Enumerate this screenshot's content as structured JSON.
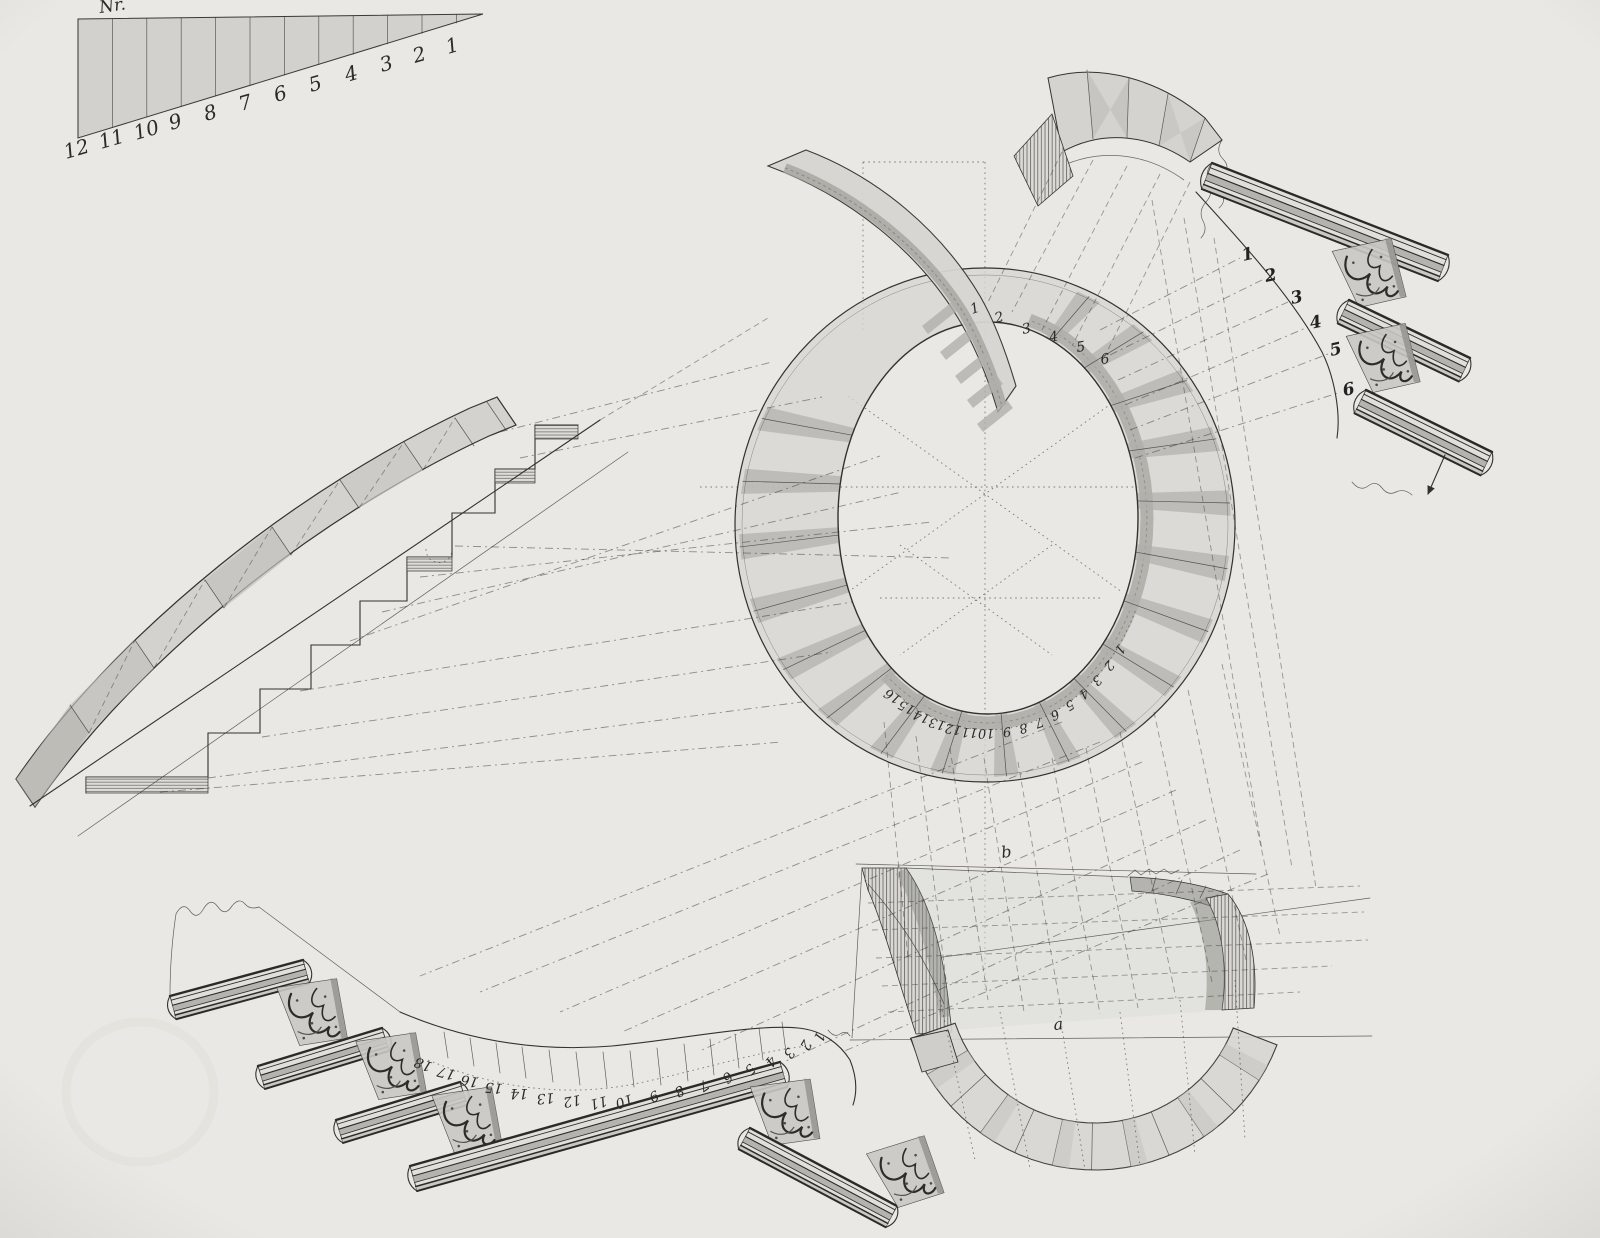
{
  "sheet": {
    "colors": {
      "paper": "#e9e8e4",
      "ink": "#33322e",
      "wash_light": "#d7d6d2",
      "wash_mid": "#c2c1bd",
      "wash_dark": "#a5a49f",
      "riser": "#b0afab",
      "hatch": "#4e4d49"
    },
    "scale_bar": {
      "label": "Nr.",
      "numbers": [
        "12",
        "11",
        "10",
        "9",
        "8",
        "7",
        "6",
        "5",
        "4",
        "3",
        "2",
        "1"
      ]
    },
    "plan": {
      "ring_numbers": [
        "16",
        "15",
        "14",
        "13",
        "12",
        "11",
        "10",
        "9",
        "8",
        "7",
        "6",
        "5",
        "4",
        "3",
        "2",
        "1"
      ],
      "winder_numbers": [
        "1",
        "2",
        "3",
        "4",
        "5",
        "6"
      ]
    },
    "step_profiles": {
      "numbers": [
        "1",
        "2",
        "3",
        "4",
        "5",
        "6"
      ]
    },
    "lower_flight": {
      "numbers": [
        "18",
        "17",
        "16",
        "15",
        "14",
        "13",
        "12",
        "11",
        "10",
        "9",
        "8",
        "7",
        "6",
        "5",
        "4",
        "3",
        "2",
        "1"
      ]
    },
    "development": {
      "letters": [
        "b",
        "a"
      ]
    }
  }
}
